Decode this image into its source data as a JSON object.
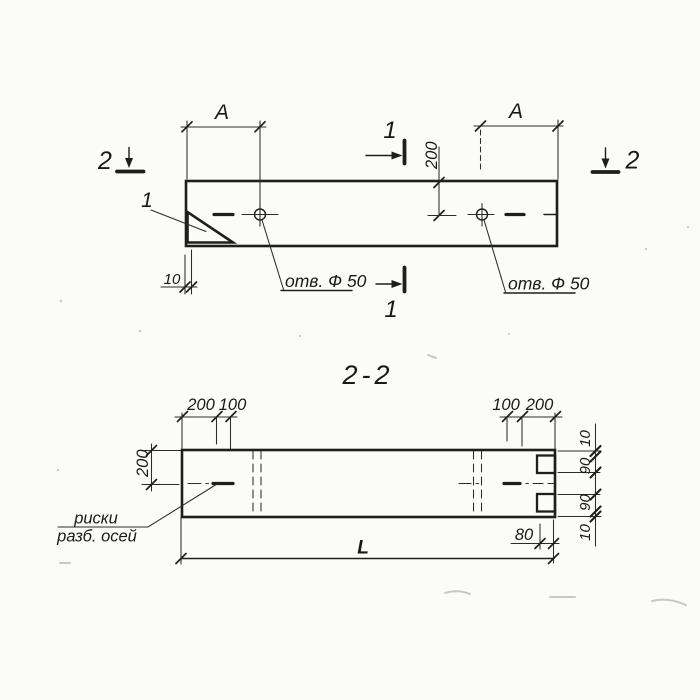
{
  "plan": {
    "dim_a_left": "A",
    "dim_a_right": "A",
    "dim_hole_offset": "200",
    "dim_plate_thickness": "10",
    "hole_label_left": "отв. Ф 50",
    "hole_label_right": "отв. Ф 50",
    "marker_1_top": "1",
    "marker_1_bottom": "1",
    "marker_2_left": "2",
    "marker_2_right": "2",
    "detail_callout": "1"
  },
  "section": {
    "title": "2-2",
    "dim_left_outer": "200",
    "dim_left_inner": "100",
    "dim_right_inner": "100",
    "dim_right_outer": "200",
    "dim_depth": "200",
    "dim_edge_top": "10",
    "dim_notch_top": "90",
    "dim_notch_bottom": "90",
    "dim_edge_bottom": "10",
    "dim_notch_depth": "80",
    "dim_length": "L",
    "axis_note_line1": "риски",
    "axis_note_line2": "разб. осей"
  },
  "colors": {
    "ink": "#1e1e1e",
    "paper": "#fbfbf8"
  }
}
